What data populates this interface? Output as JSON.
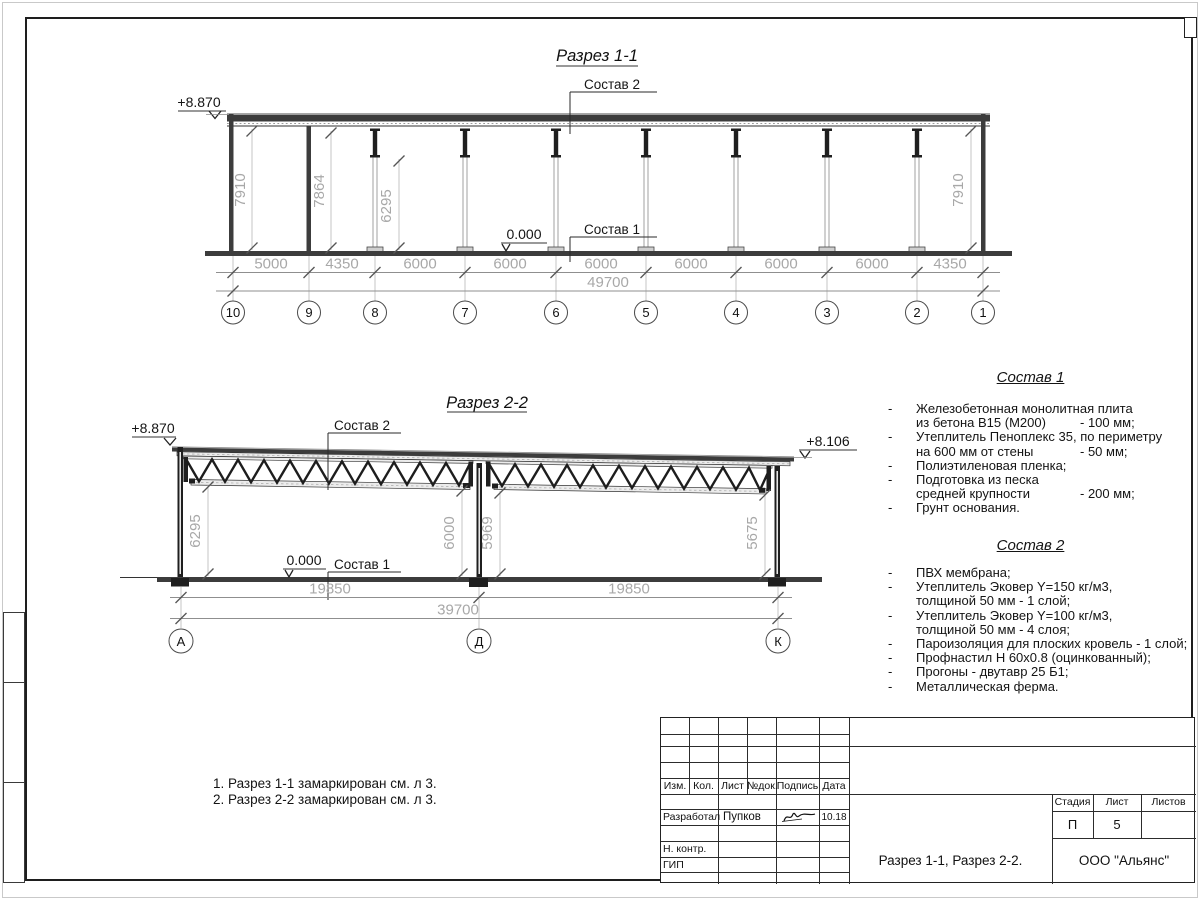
{
  "list_dash": "-",
  "section1": {
    "title": "Разрез 1-1",
    "elev_top": "+8.870",
    "elev_zero": "0.000",
    "sostav1_label": "Состав 1",
    "sostav2_label": "Состав 2",
    "dims_bottom": [
      "5000",
      "4350",
      "6000",
      "6000",
      "6000",
      "6000",
      "6000",
      "6000",
      "4350"
    ],
    "dim_total": "49700",
    "dims_vertical": [
      "7910",
      "7864",
      "6295",
      "7910"
    ],
    "axes": [
      "10",
      "9",
      "8",
      "7",
      "6",
      "5",
      "4",
      "3",
      "2",
      "1"
    ]
  },
  "section2": {
    "title": "Разрез 2-2",
    "elev_left": "+8.870",
    "elev_right": "+8.106",
    "elev_zero": "0.000",
    "sostav1_label": "Состав 1",
    "sostav2_label": "Состав 2",
    "dims_bottom": [
      "19850",
      "19850"
    ],
    "dim_total": "39700",
    "dims_vertical": [
      "6295",
      "6000",
      "5969",
      "5675"
    ],
    "axes": [
      "А",
      "Д",
      "К"
    ]
  },
  "sostav1": {
    "title": "Состав 1",
    "lines": [
      {
        "t": "Железобетонная  монолитная плита",
        "v": ""
      },
      {
        "t": "из бетона В15 (М200)",
        "v": "- 100 мм;"
      },
      {
        "t": "Утеплитель Пеноплекс 35, по периметру",
        "v": ""
      },
      {
        "t": "на 600 мм от стены",
        "v": "- 50 мм;"
      },
      {
        "t": "Полиэтиленовая пленка;",
        "v": ""
      },
      {
        "t": "Подготовка из песка",
        "v": ""
      },
      {
        "t": "средней крупности",
        "v": "- 200 мм;"
      },
      {
        "t": "Грунт основания.",
        "v": ""
      }
    ]
  },
  "sostav2": {
    "title": "Состав 2",
    "lines": [
      {
        "t": "ПВХ мембрана;",
        "v": ""
      },
      {
        "t": "Утеплитель Эковер Y=150 кг/м3,",
        "v": ""
      },
      {
        "t": "толщиной 50 мм - 1 слой;",
        "v": ""
      },
      {
        "t": "Утеплитель Эковер Y=100 кг/м3,",
        "v": ""
      },
      {
        "t": "толщиной 50 мм - 4 слоя;",
        "v": ""
      },
      {
        "t": "Пароизоляция для плоских кровель - 1 слой;",
        "v": ""
      },
      {
        "t": "Профнастил Н 60х0.8 (оцинкованный);",
        "v": ""
      },
      {
        "t": "Прогоны - двутавр 25 Б1;",
        "v": ""
      },
      {
        "t": "Металлическая ферма.",
        "v": ""
      }
    ]
  },
  "notes": [
    "1. Разрез 1-1 замаркирован см. л 3.",
    "2. Разрез 2-2 замаркирован см. л 3."
  ],
  "title_block": {
    "headers": {
      "izm": "Изм.",
      "kol": "Кол.",
      "list": "Лист",
      "doc": "№док.",
      "sign": "Подпись",
      "date": "Дата"
    },
    "developed_label": "Разработал",
    "developed_name": "Пупков",
    "developed_date": "10.18",
    "ncontr_label": "Н. контр.",
    "gip_label": "ГИП",
    "doc_title": "Разрез 1-1, Разрез 2-2.",
    "stage_label": "Стадия",
    "sheet_label": "Лист",
    "sheets_label": "Листов",
    "stage": "П",
    "sheet_no": "5",
    "org": "ООО \"Альянс\""
  }
}
